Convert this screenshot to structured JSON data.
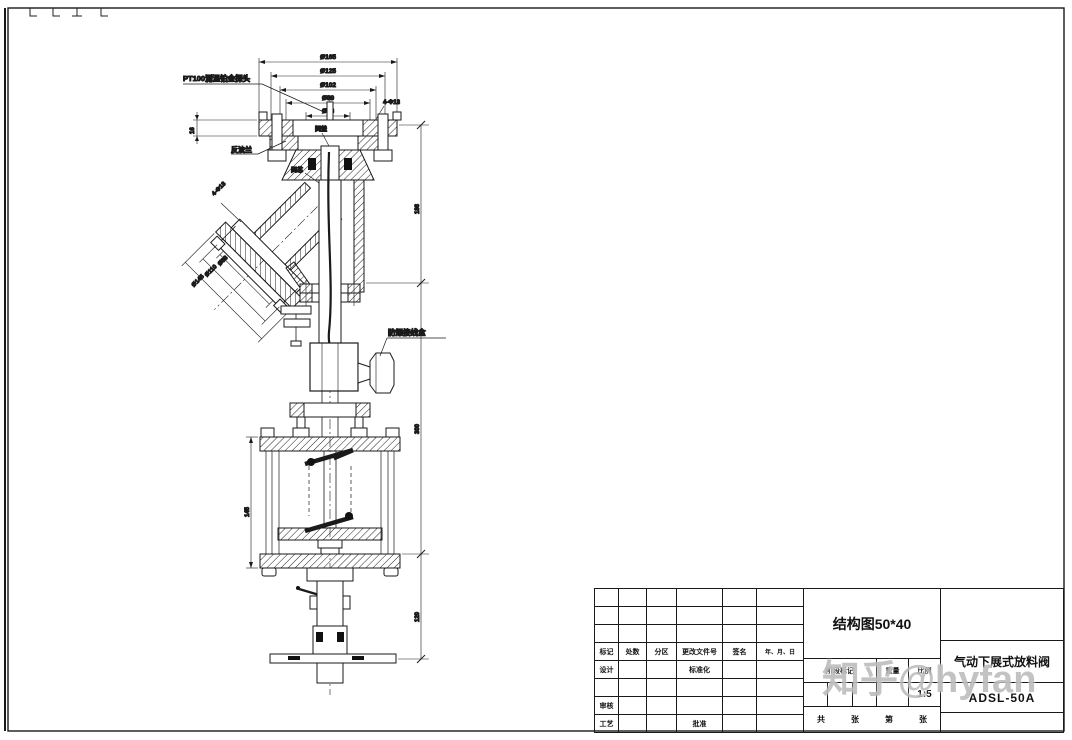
{
  "colors": {
    "line": "#1a1a1a",
    "watermark": "#9e9e9e"
  },
  "watermark": {
    "text": "知乎@hyfan"
  },
  "annotations": {
    "pt100_probe": "PT100测温铂金探头",
    "counter_flange": "反法兰",
    "bonnet": "阀盖",
    "valve_core": "阀芯",
    "junction_box": "防爆接线盒"
  },
  "dimensions": {
    "top_flange": [
      "Ø165",
      "Ø125",
      "Ø102",
      "Ø89",
      "Ø48"
    ],
    "top_flange_holes": "4-Φ18",
    "flange_thickness": "16",
    "branch_holes": "4-Φ18",
    "branch_flange": [
      "Ø88",
      "Ø110",
      "Ø145"
    ],
    "right_upper": "186",
    "right_middle": "300",
    "right_lower": "120",
    "cylinder_height": "145"
  },
  "title_block": {
    "drawing_title": "结构图50*40",
    "product_name": "气动下展式放料阀",
    "model_code": "ADSL-50A",
    "scale_value": "1:5",
    "rev_header": [
      "标记",
      "处数",
      "分区",
      "更改文件号",
      "签名",
      "年、月、日"
    ],
    "roles": {
      "design": "设计",
      "standardization": "标准化",
      "review": "审核",
      "process": "工艺",
      "approve": "批准"
    },
    "info_header": {
      "stage_mark": "阶段标记",
      "weight": "重量",
      "scale": "比例"
    },
    "sheet_info": {
      "total": "共",
      "sheet_unit1": "张",
      "no": "第",
      "sheet_unit2": "张"
    }
  }
}
